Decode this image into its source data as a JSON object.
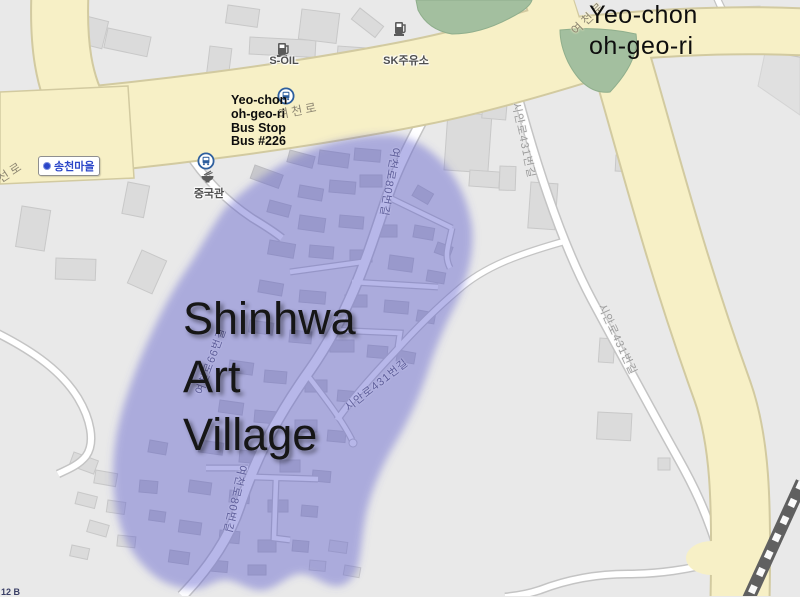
{
  "map": {
    "overlay_title": {
      "lines": [
        "Yeo-chon",
        "oh-geo-ri"
      ]
    },
    "bus_stop_note": {
      "lines": [
        "Yeo-chon",
        "oh-geo-ri",
        "Bus Stop",
        "Bus #226"
      ]
    },
    "highlight_title": {
      "lines": [
        "Shinhwa",
        "Art",
        "Village"
      ]
    },
    "poi": {
      "s_oil": "S-OIL",
      "sk_station": "SK주유소",
      "songcheon_village": "송천마을",
      "china_restaurant": "중국관"
    },
    "roads": {
      "yeocheon_ro_a": "여천로",
      "yeocheon_ro_b": "여천로",
      "seon_ro_partial": "선로",
      "yeocheon_80_a": "여천로80번길",
      "yeocheon_80_b": "여천로80번길",
      "yeocheon_66": "여천로66번길",
      "sian_431_a": "시안로431번길",
      "sian_431_b": "시안로431번길",
      "sian_431_c": "시안로431번길",
      "corner_partial": "12 B"
    },
    "icons": {
      "bus_stop": "bus in blue circle",
      "fuel_pump": "gray fuel pump",
      "restaurant": "noodle bowl",
      "village_marker": "blue dot"
    },
    "colors": {
      "highlight_purple": "#5a5acd",
      "road_yellow": "#f7f0c6",
      "green_area": "#a3bf9f",
      "background": "#e9e9e9",
      "poi_blue": "#2b46c8",
      "bus_icon_blue": "#2e5f9e"
    }
  }
}
